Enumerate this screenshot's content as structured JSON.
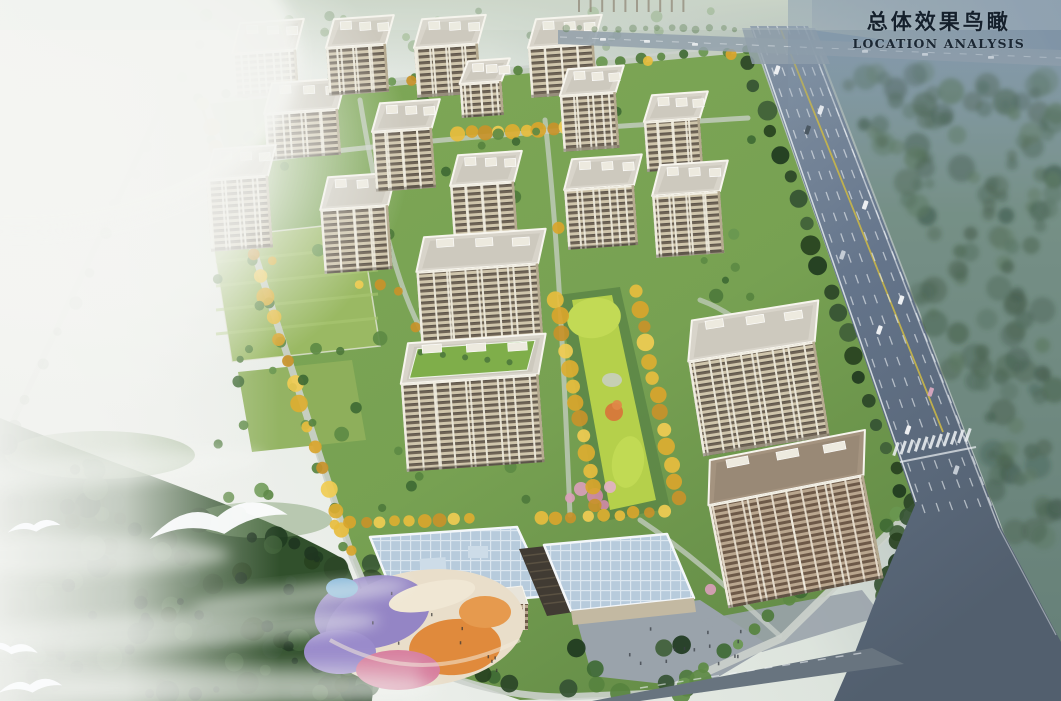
{
  "title": {
    "zh": "总体效果鸟瞰",
    "en": "LOCATION ANALYSIS"
  },
  "scene_labels": {
    "rendering": "aerial-birdseye-rendering",
    "highway": "highway-road",
    "towers": "residential-towers",
    "axis": "central-landscape-axis",
    "school": "kindergarten-school-buildings",
    "playground": "playground",
    "forest": "forest",
    "birds": "flying-birds"
  },
  "palette": {
    "title_text": "#15202c",
    "sky_top_right": "#7b90a4",
    "fog_white": "#f0f2ee",
    "highway_asphalt": "#5f6e80",
    "lane_line_white": "#eef2f5",
    "center_line_yellow": "#c9b648",
    "forest_dark_green": "#35502f",
    "site_green": "#77a152",
    "lawn_bright": "#b5d04b",
    "golden_tree": "#e7bd3e",
    "blossom_pink": "#d9a0b8",
    "facade_beige": "#cfc5ab",
    "facade_band_brown": "#6f6456",
    "roof_gray": "#d8d4ca",
    "green_roof": "#7fae4a",
    "school_roof_blue": "#b7cbdc",
    "plaza_gray": "#9aa3ab",
    "playground_purple": "#8f7fc4",
    "playground_orange": "#e08a3c",
    "playground_pink": "#d77f9e",
    "playground_cream": "#e9deca",
    "bird_white": "#fbfcfd"
  }
}
